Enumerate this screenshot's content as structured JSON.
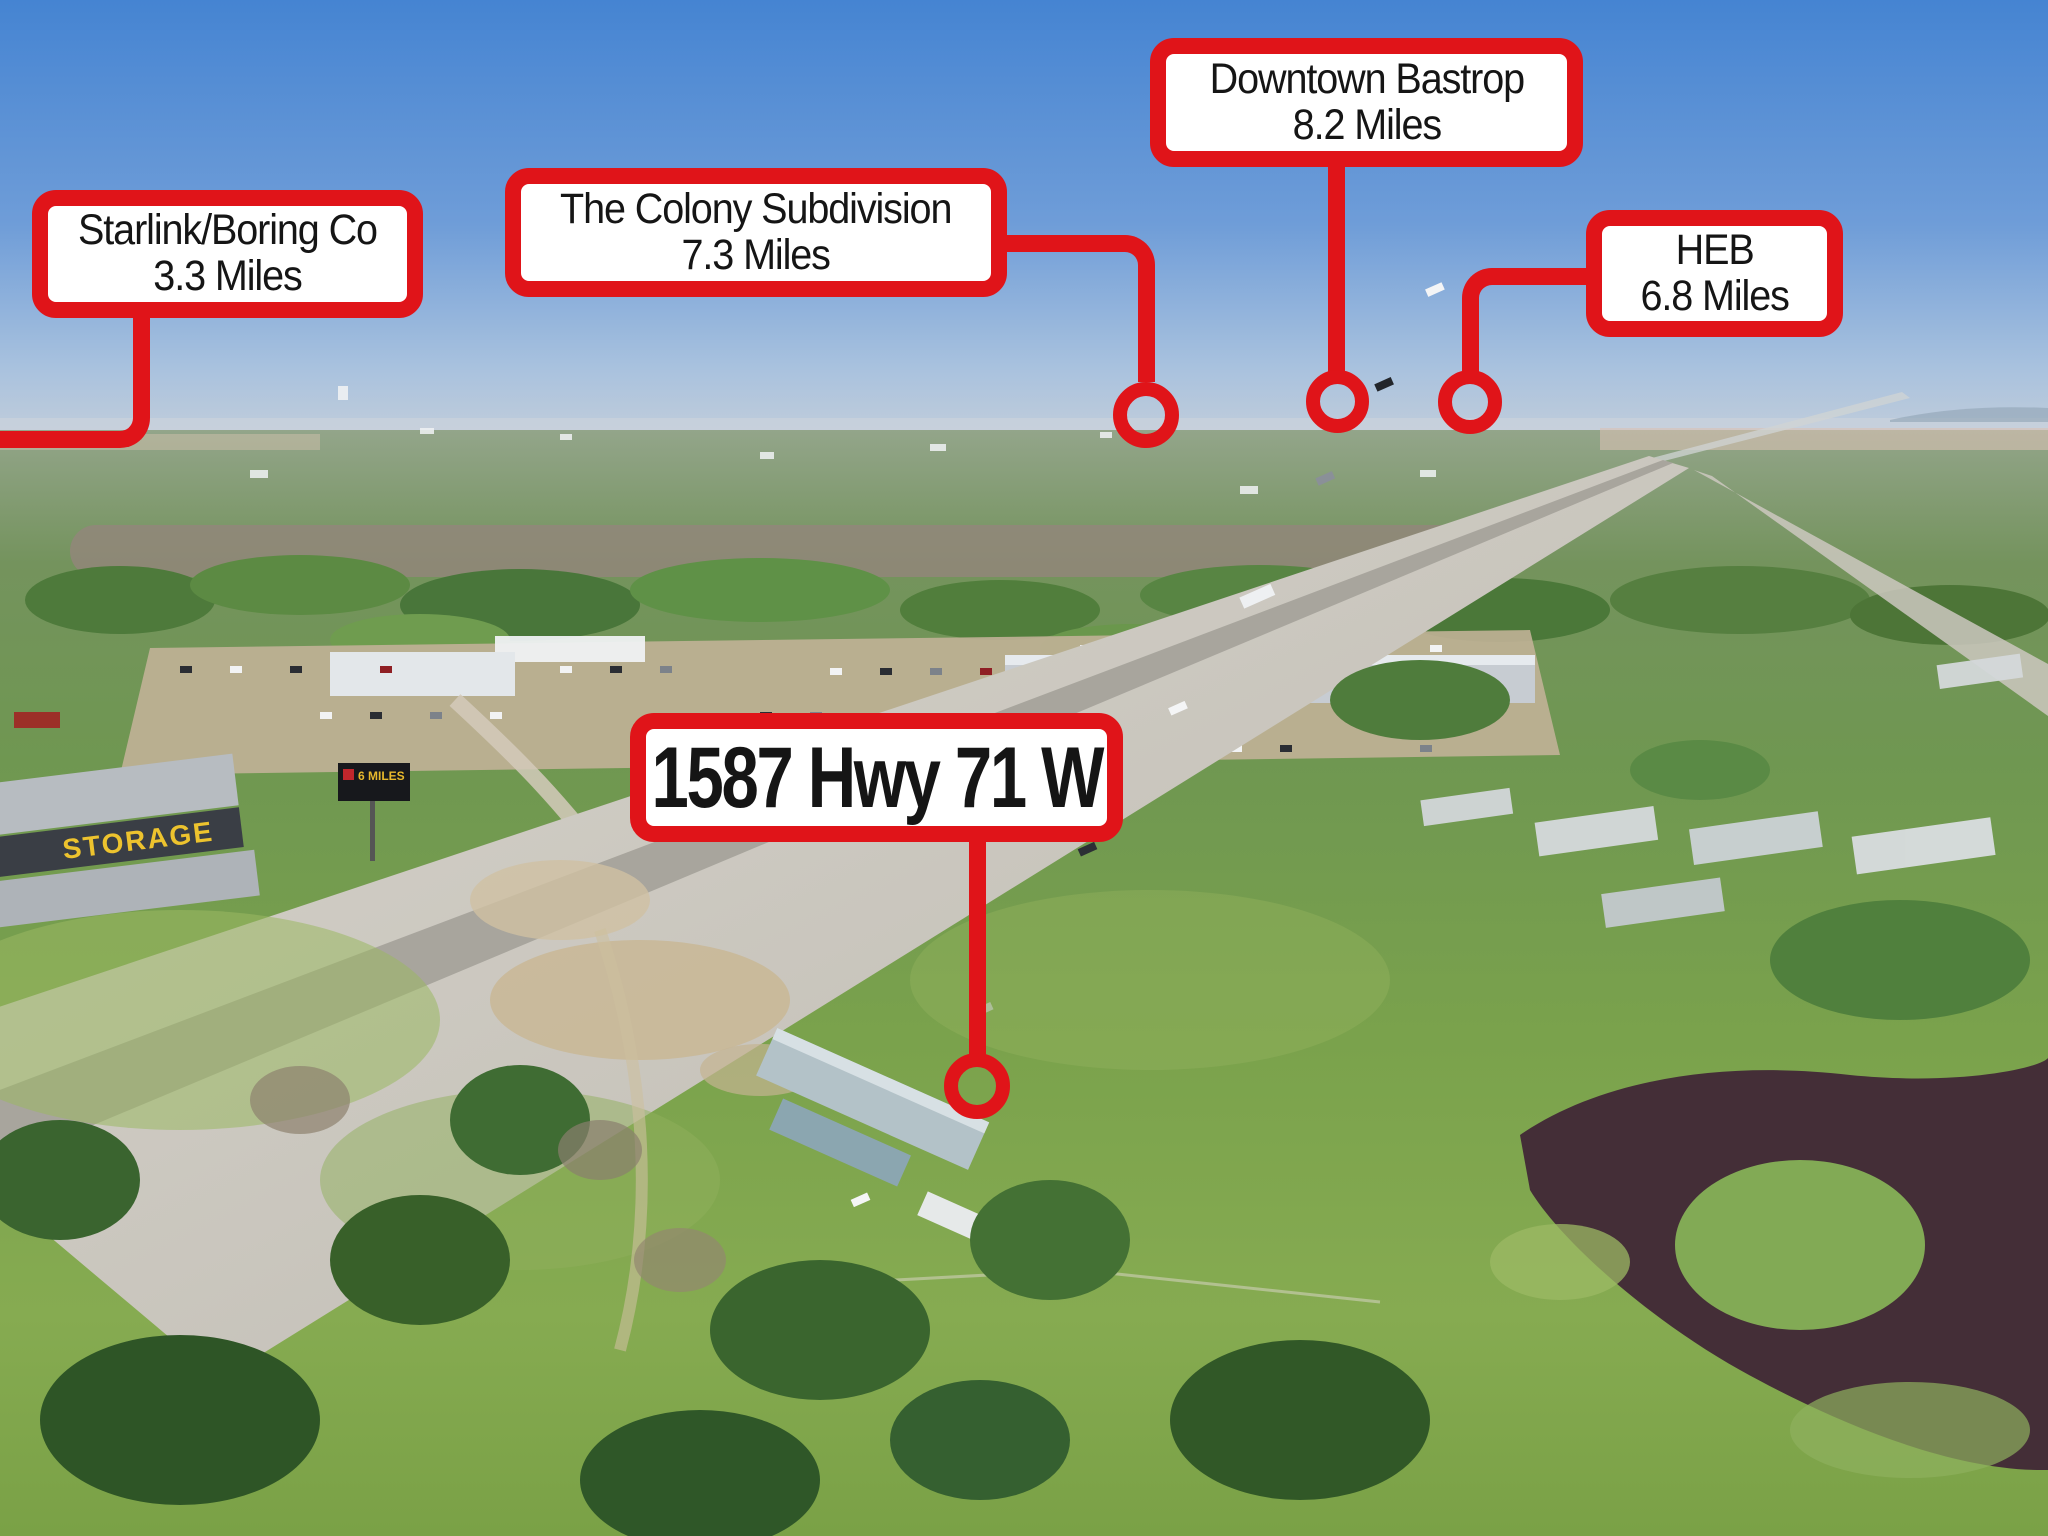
{
  "colors": {
    "annotation_red": "#e01419",
    "box_background": "#ffffff",
    "label_text": "#151515"
  },
  "callouts": [
    {
      "id": "starlink",
      "line1": "Starlink/Boring Co",
      "line2": "3.3 Miles"
    },
    {
      "id": "colony",
      "line1": "The Colony Subdivision",
      "line2": "7.3 Miles"
    },
    {
      "id": "downtown-bastrop",
      "line1": "Downtown Bastrop",
      "line2": "8.2 Miles"
    },
    {
      "id": "heb",
      "line1": "HEB",
      "line2": "6.8 Miles"
    },
    {
      "id": "property-address",
      "line1": "1587 Hwy 71 W"
    }
  ],
  "photo_text": {
    "storage_sign": "STORAGE",
    "billboard": "6 MILES"
  }
}
